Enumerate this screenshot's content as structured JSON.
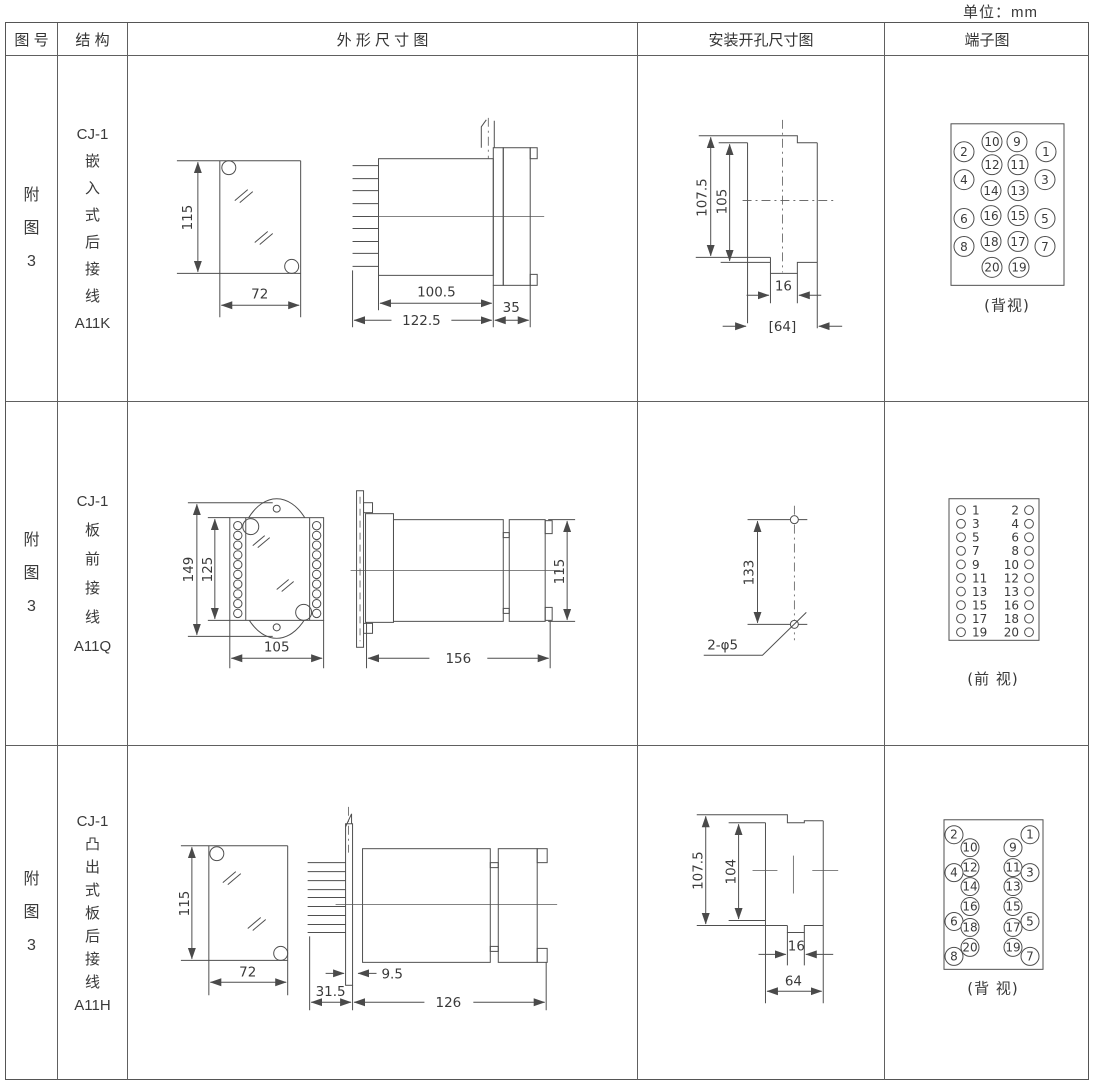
{
  "unit_label": "单位：mm",
  "headers": {
    "figure": "图 号",
    "structure": "结 构",
    "outline": "外 形 尺 寸 图",
    "mounting": "安装开孔尺寸图",
    "terminal": "端子图"
  },
  "rows": [
    {
      "figure_lines": [
        "附",
        "图",
        "3"
      ],
      "structure_lines": [
        "CJ-1",
        "嵌",
        "入",
        "式",
        "后",
        "接",
        "线",
        "A11K"
      ],
      "outline": {
        "front_h": "115",
        "front_w": "72",
        "body_l": "100.5",
        "total_l": "122.5",
        "cover_l": "35"
      },
      "mounting": {
        "outer_h": "107.5",
        "inner_h": "105",
        "notch_w": "16",
        "span_w": "[64]"
      },
      "terminal": {
        "caption": "(背视)",
        "pins": [
          {
            "n": "10",
            "x": 991,
            "y": 141
          },
          {
            "n": "9",
            "x": 1016,
            "y": 141
          },
          {
            "n": "2",
            "x": 963,
            "y": 151
          },
          {
            "n": "1",
            "x": 1045,
            "y": 151
          },
          {
            "n": "12",
            "x": 991,
            "y": 164
          },
          {
            "n": "11",
            "x": 1017,
            "y": 164
          },
          {
            "n": "4",
            "x": 963,
            "y": 179
          },
          {
            "n": "3",
            "x": 1044,
            "y": 179
          },
          {
            "n": "14",
            "x": 990,
            "y": 190
          },
          {
            "n": "13",
            "x": 1017,
            "y": 190
          },
          {
            "n": "6",
            "x": 963,
            "y": 218
          },
          {
            "n": "16",
            "x": 990,
            "y": 215
          },
          {
            "n": "15",
            "x": 1017,
            "y": 215
          },
          {
            "n": "5",
            "x": 1044,
            "y": 218
          },
          {
            "n": "8",
            "x": 963,
            "y": 246
          },
          {
            "n": "18",
            "x": 990,
            "y": 241
          },
          {
            "n": "17",
            "x": 1017,
            "y": 241
          },
          {
            "n": "7",
            "x": 1044,
            "y": 246
          },
          {
            "n": "20",
            "x": 991,
            "y": 267
          },
          {
            "n": "19",
            "x": 1018,
            "y": 267
          }
        ]
      }
    },
    {
      "figure_lines": [
        "附",
        "图",
        "3"
      ],
      "structure_lines": [
        "CJ-1",
        "板",
        "前",
        "接",
        "线",
        "A11Q"
      ],
      "outline": {
        "front_h": "149",
        "inner_h": "125",
        "front_w": "105",
        "side_l": "156",
        "side_h": "115"
      },
      "mounting": {
        "hole_dist": "133",
        "holes_label": "2-φ5"
      },
      "terminal": {
        "caption": "(前 视)",
        "left_nums": [
          "1",
          "3",
          "5",
          "7",
          "9",
          "11",
          "13",
          "15",
          "17",
          "19"
        ],
        "right_nums": [
          "2",
          "4",
          "6",
          "8",
          "10",
          "12",
          "13",
          "16",
          "18",
          "20"
        ]
      }
    },
    {
      "figure_lines": [
        "附",
        "图",
        "3"
      ],
      "structure_lines": [
        "CJ-1",
        "凸",
        "出",
        "式",
        "板",
        "后",
        "接",
        "线",
        "A11H"
      ],
      "outline": {
        "front_h": "115",
        "front_w": "72",
        "plate_offset": "31.5",
        "gap": "9.5",
        "body_l": "126"
      },
      "mounting": {
        "outer_h": "107.5",
        "inner_h": "104",
        "notch_w": "16",
        "span_w": "64"
      },
      "terminal": {
        "caption": "(背 视)",
        "pins": [
          {
            "n": "2",
            "x": 953,
            "y": 834
          },
          {
            "n": "1",
            "x": 1029,
            "y": 834
          },
          {
            "n": "10",
            "x": 969,
            "y": 847
          },
          {
            "n": "9",
            "x": 1012,
            "y": 847
          },
          {
            "n": "12",
            "x": 969,
            "y": 867
          },
          {
            "n": "11",
            "x": 1012,
            "y": 867
          },
          {
            "n": "4",
            "x": 953,
            "y": 872
          },
          {
            "n": "3",
            "x": 1029,
            "y": 872
          },
          {
            "n": "14",
            "x": 969,
            "y": 886
          },
          {
            "n": "13",
            "x": 1012,
            "y": 886
          },
          {
            "n": "16",
            "x": 969,
            "y": 906
          },
          {
            "n": "15",
            "x": 1012,
            "y": 906
          },
          {
            "n": "6",
            "x": 953,
            "y": 921
          },
          {
            "n": "5",
            "x": 1029,
            "y": 921
          },
          {
            "n": "18",
            "x": 969,
            "y": 927
          },
          {
            "n": "17",
            "x": 1012,
            "y": 927
          },
          {
            "n": "20",
            "x": 969,
            "y": 947
          },
          {
            "n": "19",
            "x": 1012,
            "y": 947
          },
          {
            "n": "8",
            "x": 953,
            "y": 956
          },
          {
            "n": "7",
            "x": 1029,
            "y": 956
          }
        ]
      }
    }
  ]
}
